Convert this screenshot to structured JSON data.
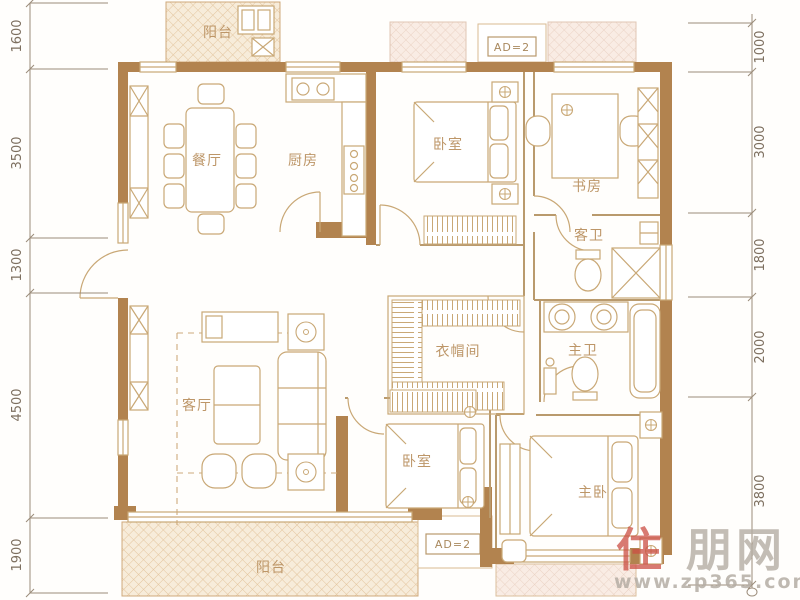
{
  "plan": {
    "type": "apartment-floor-plan",
    "rooms": [
      {
        "id": "dining",
        "label": "餐厅"
      },
      {
        "id": "kitchen",
        "label": "厨房"
      },
      {
        "id": "bedroom1",
        "label": "卧室"
      },
      {
        "id": "study",
        "label": "书房"
      },
      {
        "id": "guest-bath",
        "label": "客卫"
      },
      {
        "id": "cloakroom",
        "label": "衣帽间"
      },
      {
        "id": "master-bath",
        "label": "主卫"
      },
      {
        "id": "living",
        "label": "客厅"
      },
      {
        "id": "bedroom2",
        "label": "卧室"
      },
      {
        "id": "master-bedroom",
        "label": "主卧"
      },
      {
        "id": "balcony-top",
        "label": "阳台"
      },
      {
        "id": "balcony-bottom",
        "label": "阳台"
      }
    ],
    "annotations": {
      "top_ad": "AD=2",
      "bottom_ad": "AD=2"
    },
    "dimensions": {
      "left": [
        {
          "v": "1600"
        },
        {
          "v": "3500"
        },
        {
          "v": "1300"
        },
        {
          "v": "4500"
        },
        {
          "v": "1900"
        }
      ],
      "right": [
        {
          "v": "1000"
        },
        {
          "v": "3000"
        },
        {
          "v": "1800"
        },
        {
          "v": "2000"
        },
        {
          "v": "3800"
        }
      ]
    },
    "colors": {
      "wall": "#b2834f",
      "thin_line": "#c9a876",
      "hatch_fill": "#f7ecda",
      "hatch_line": "#e3c59e",
      "room_label": "#bd9668",
      "dimension_text": "#7d6f5f",
      "watermark_red": "#cc4f44",
      "watermark_gray": "#b5ada4"
    }
  },
  "watermark": {
    "brand_red": "住",
    "brand_gray": "朋网",
    "url": "www.zp365.com"
  }
}
